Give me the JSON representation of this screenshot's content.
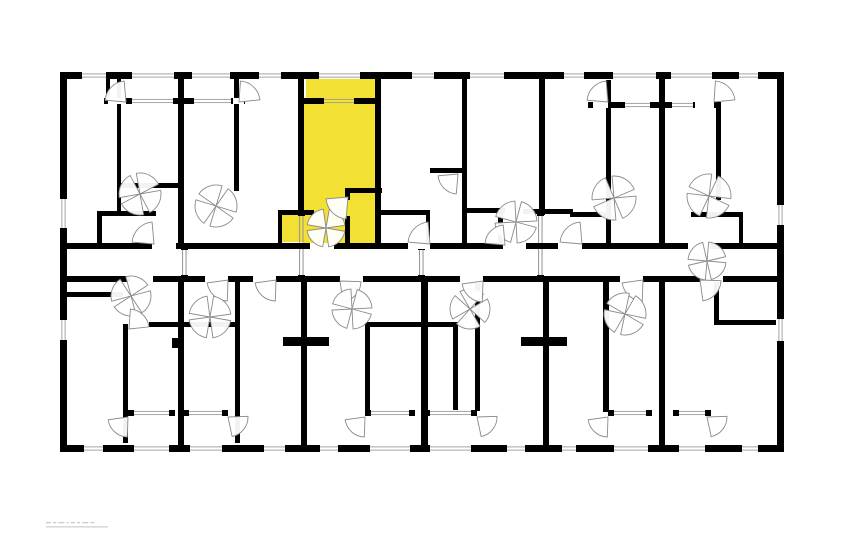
{
  "canvas": {
    "width": 862,
    "height": 555,
    "background": "#ffffff"
  },
  "colors": {
    "wall": "#000000",
    "highlight": "#F2E032",
    "arc_stroke": "#8a8a8a",
    "glazing_line": "#9b9b9b",
    "watermark_gray": "#b9b9b9"
  },
  "plan": {
    "highlighted_unit": {
      "fill": "#F2E032",
      "areas": [
        [
          306,
          79,
          69,
          19
        ],
        [
          304,
          104,
          71,
          139
        ],
        [
          281,
          215,
          23,
          27
        ]
      ]
    },
    "walls": [
      [
        60,
        72,
        724,
        7
      ],
      [
        60,
        445,
        724,
        7
      ],
      [
        60,
        72,
        7,
        380
      ],
      [
        777,
        72,
        7,
        380
      ],
      [
        60,
        243,
        724,
        6
      ],
      [
        60,
        276,
        724,
        6
      ],
      [
        106,
        79,
        4,
        19
      ],
      [
        117,
        79,
        4,
        132
      ],
      [
        178,
        72,
        6,
        177
      ],
      [
        234,
        79,
        5,
        112
      ],
      [
        298,
        72,
        6,
        143
      ],
      [
        375,
        72,
        6,
        177
      ],
      [
        462,
        72,
        5,
        171
      ],
      [
        539,
        72,
        6,
        143
      ],
      [
        606,
        80,
        5,
        167
      ],
      [
        659,
        72,
        6,
        177
      ],
      [
        716,
        102,
        5,
        98
      ],
      [
        104,
        98,
        141,
        6
      ],
      [
        298,
        98,
        83,
        6
      ],
      [
        588,
        102,
        133,
        6
      ],
      [
        120,
        183,
        62,
        5
      ],
      [
        97,
        211,
        59,
        5
      ],
      [
        97,
        211,
        5,
        34
      ],
      [
        345,
        188,
        37,
        5
      ],
      [
        345,
        188,
        5,
        12
      ],
      [
        345,
        216,
        5,
        29
      ],
      [
        278,
        210,
        36,
        5
      ],
      [
        278,
        212,
        4,
        32
      ],
      [
        381,
        210,
        49,
        5
      ],
      [
        426,
        210,
        4,
        35
      ],
      [
        430,
        168,
        34,
        5
      ],
      [
        462,
        208,
        43,
        5
      ],
      [
        498,
        213,
        5,
        34
      ],
      [
        523,
        209,
        50,
        5
      ],
      [
        570,
        212,
        37,
        5
      ],
      [
        691,
        212,
        52,
        5
      ],
      [
        739,
        217,
        4,
        28
      ],
      [
        123,
        324,
        5,
        119
      ],
      [
        178,
        276,
        6,
        171
      ],
      [
        235,
        282,
        5,
        161
      ],
      [
        301,
        276,
        6,
        171
      ],
      [
        421,
        276,
        7,
        171
      ],
      [
        475,
        283,
        5,
        128
      ],
      [
        543,
        276,
        6,
        171
      ],
      [
        603,
        282,
        6,
        130
      ],
      [
        659,
        276,
        6,
        171
      ],
      [
        714,
        282,
        5,
        43
      ],
      [
        60,
        292,
        63,
        5
      ],
      [
        149,
        322,
        90,
        5
      ],
      [
        365,
        322,
        59,
        5
      ],
      [
        424,
        322,
        34,
        5
      ],
      [
        365,
        323,
        5,
        89
      ],
      [
        453,
        323,
        5,
        89
      ],
      [
        283,
        337,
        46,
        9
      ],
      [
        521,
        337,
        46,
        9
      ],
      [
        172,
        338,
        8,
        10
      ],
      [
        714,
        320,
        62,
        5
      ],
      [
        128,
        410,
        47,
        6
      ],
      [
        183,
        410,
        45,
        6
      ],
      [
        365,
        410,
        50,
        6
      ],
      [
        424,
        410,
        53,
        6
      ],
      [
        608,
        410,
        44,
        6
      ],
      [
        673,
        410,
        38,
        6
      ]
    ],
    "openings": [
      {
        "x": 80,
        "y": 72,
        "w": 28,
        "h": 7,
        "t": "window"
      },
      {
        "x": 130,
        "y": 72,
        "w": 46,
        "h": 7,
        "t": "glazing"
      },
      {
        "x": 190,
        "y": 72,
        "w": 42,
        "h": 7,
        "t": "glazing"
      },
      {
        "x": 257,
        "y": 72,
        "w": 26,
        "h": 7,
        "t": "window"
      },
      {
        "x": 317,
        "y": 72,
        "w": 45,
        "h": 7,
        "t": "glazing"
      },
      {
        "x": 410,
        "y": 72,
        "w": 26,
        "h": 7,
        "t": "window"
      },
      {
        "x": 468,
        "y": 72,
        "w": 38,
        "h": 7,
        "t": "window"
      },
      {
        "x": 562,
        "y": 72,
        "w": 24,
        "h": 7,
        "t": "window"
      },
      {
        "x": 611,
        "y": 72,
        "w": 47,
        "h": 7,
        "t": "glazing"
      },
      {
        "x": 669,
        "y": 72,
        "w": 45,
        "h": 7,
        "t": "glazing"
      },
      {
        "x": 737,
        "y": 72,
        "w": 23,
        "h": 7,
        "t": "window"
      },
      {
        "x": 82,
        "y": 445,
        "w": 23,
        "h": 7,
        "t": "window"
      },
      {
        "x": 132,
        "y": 445,
        "w": 39,
        "h": 7,
        "t": "glazing"
      },
      {
        "x": 188,
        "y": 445,
        "w": 36,
        "h": 7,
        "t": "glazing"
      },
      {
        "x": 262,
        "y": 445,
        "w": 25,
        "h": 7,
        "t": "window"
      },
      {
        "x": 318,
        "y": 445,
        "w": 22,
        "h": 7,
        "t": "window"
      },
      {
        "x": 368,
        "y": 445,
        "w": 44,
        "h": 7,
        "t": "glazing"
      },
      {
        "x": 428,
        "y": 445,
        "w": 45,
        "h": 7,
        "t": "glazing"
      },
      {
        "x": 505,
        "y": 445,
        "w": 22,
        "h": 7,
        "t": "window"
      },
      {
        "x": 560,
        "y": 445,
        "w": 18,
        "h": 7,
        "t": "window"
      },
      {
        "x": 612,
        "y": 445,
        "w": 38,
        "h": 7,
        "t": "glazing"
      },
      {
        "x": 677,
        "y": 445,
        "w": 30,
        "h": 7,
        "t": "glazing"
      },
      {
        "x": 740,
        "y": 445,
        "w": 20,
        "h": 7,
        "t": "window"
      },
      {
        "x": 60,
        "y": 197,
        "w": 7,
        "h": 33,
        "t": "window"
      },
      {
        "x": 60,
        "y": 318,
        "w": 7,
        "h": 24,
        "t": "window"
      },
      {
        "x": 777,
        "y": 203,
        "w": 7,
        "h": 24,
        "t": "window"
      },
      {
        "x": 777,
        "y": 317,
        "w": 7,
        "h": 26,
        "t": "window"
      },
      {
        "x": 130,
        "y": 98,
        "w": 45,
        "h": 6,
        "t": "glazing"
      },
      {
        "x": 192,
        "y": 98,
        "w": 41,
        "h": 6,
        "t": "glazing"
      },
      {
        "x": 322,
        "y": 98,
        "w": 34,
        "h": 6,
        "t": "glazing",
        "bg": "#F2E032"
      },
      {
        "x": 623,
        "y": 102,
        "w": 29,
        "h": 6,
        "t": "glazing"
      },
      {
        "x": 670,
        "y": 102,
        "w": 25,
        "h": 6,
        "t": "glazing"
      },
      {
        "x": 108,
        "y": 98,
        "w": 18,
        "h": 6,
        "t": "gap"
      },
      {
        "x": 233,
        "y": 98,
        "w": 11,
        "h": 6,
        "t": "gap"
      },
      {
        "x": 593,
        "y": 102,
        "w": 15,
        "h": 6,
        "t": "gap"
      },
      {
        "x": 695,
        "y": 102,
        "w": 19,
        "h": 6,
        "t": "gap"
      },
      {
        "x": 152,
        "y": 243,
        "w": 24,
        "h": 6,
        "t": "gap"
      },
      {
        "x": 310,
        "y": 243,
        "w": 24,
        "h": 6,
        "t": "gap"
      },
      {
        "x": 408,
        "y": 243,
        "w": 22,
        "h": 6,
        "t": "gap"
      },
      {
        "x": 503,
        "y": 243,
        "w": 23,
        "h": 6,
        "t": "gap"
      },
      {
        "x": 558,
        "y": 243,
        "w": 24,
        "h": 6,
        "t": "gap"
      },
      {
        "x": 688,
        "y": 243,
        "w": 22,
        "h": 6,
        "t": "gap"
      },
      {
        "x": 130,
        "y": 276,
        "w": 23,
        "h": 6,
        "t": "gap"
      },
      {
        "x": 205,
        "y": 276,
        "w": 23,
        "h": 6,
        "t": "gap"
      },
      {
        "x": 253,
        "y": 276,
        "w": 23,
        "h": 6,
        "t": "gap"
      },
      {
        "x": 340,
        "y": 276,
        "w": 23,
        "h": 6,
        "t": "gap"
      },
      {
        "x": 460,
        "y": 276,
        "w": 23,
        "h": 6,
        "t": "gap"
      },
      {
        "x": 620,
        "y": 276,
        "w": 23,
        "h": 6,
        "t": "gap"
      },
      {
        "x": 700,
        "y": 276,
        "w": 23,
        "h": 6,
        "t": "gap"
      },
      {
        "x": 132,
        "y": 410,
        "w": 39,
        "h": 6,
        "t": "glazing"
      },
      {
        "x": 187,
        "y": 410,
        "w": 37,
        "h": 6,
        "t": "glazing"
      },
      {
        "x": 369,
        "y": 410,
        "w": 42,
        "h": 6,
        "t": "glazing"
      },
      {
        "x": 428,
        "y": 410,
        "w": 45,
        "h": 6,
        "t": "glazing"
      },
      {
        "x": 612,
        "y": 410,
        "w": 36,
        "h": 6,
        "t": "glazing"
      },
      {
        "x": 677,
        "y": 410,
        "w": 30,
        "h": 6,
        "t": "glazing"
      }
    ],
    "partitions": [
      {
        "x": 182,
        "y": 249,
        "h": 27
      },
      {
        "x": 299,
        "y": 215,
        "h": 61
      },
      {
        "x": 419,
        "y": 249,
        "h": 27
      },
      {
        "x": 538,
        "y": 215,
        "h": 61
      }
    ],
    "doors": [
      {
        "c": [
          126,
          102
        ],
        "r": 21,
        "a": 185,
        "p": 1
      },
      {
        "c": [
          239,
          102
        ],
        "r": 21,
        "a": 274,
        "p": 1
      },
      {
        "c": [
          608,
          102
        ],
        "r": 21,
        "a": 185,
        "p": 1
      },
      {
        "c": [
          714,
          102
        ],
        "r": 21,
        "a": 274,
        "p": 1
      },
      {
        "c": [
          140,
          194
        ],
        "r": 21,
        "a": -10,
        "p": 4
      },
      {
        "c": [
          216,
          206
        ],
        "r": 21,
        "a": 35,
        "p": 4
      },
      {
        "c": [
          326,
          228
        ],
        "r": 19,
        "a": 10,
        "p": 4
      },
      {
        "c": [
          348,
          197
        ],
        "r": 22,
        "a": 95,
        "p": 1
      },
      {
        "c": [
          430,
          244
        ],
        "r": 22,
        "a": 185,
        "p": 1
      },
      {
        "c": [
          458,
          174
        ],
        "r": 20,
        "a": 95,
        "p": 1
      },
      {
        "c": [
          516,
          222
        ],
        "r": 21,
        "a": 15,
        "p": 4
      },
      {
        "c": [
          614,
          198
        ],
        "r": 22,
        "a": -5,
        "p": 4
      },
      {
        "c": [
          709,
          196
        ],
        "r": 22,
        "a": 25,
        "p": 4
      },
      {
        "c": [
          154,
          244
        ],
        "r": 22,
        "a": 185,
        "p": 1
      },
      {
        "c": [
          505,
          245
        ],
        "r": 20,
        "a": 185,
        "p": 1
      },
      {
        "c": [
          582,
          244
        ],
        "r": 22,
        "a": 185,
        "p": 1
      },
      {
        "c": [
          707,
          261
        ],
        "r": 19,
        "a": 5,
        "p": 4
      },
      {
        "c": [
          131,
          296
        ],
        "r": 20,
        "a": -15,
        "p": 4
      },
      {
        "c": [
          129,
          329
        ],
        "r": 20,
        "a": 274,
        "p": 1
      },
      {
        "c": [
          228,
          280
        ],
        "r": 21,
        "a": 92,
        "p": 1
      },
      {
        "c": [
          210,
          317
        ],
        "r": 21,
        "a": 10,
        "p": 4
      },
      {
        "c": [
          276,
          280
        ],
        "r": 21,
        "a": 92,
        "p": 1
      },
      {
        "c": [
          340,
          281
        ],
        "r": 21,
        "a": 2,
        "p": 1
      },
      {
        "c": [
          352,
          309
        ],
        "r": 20,
        "a": 15,
        "p": 4
      },
      {
        "c": [
          470,
          309
        ],
        "r": 20,
        "a": 150,
        "p": 4
      },
      {
        "c": [
          483,
          281
        ],
        "r": 21,
        "a": 92,
        "p": 1
      },
      {
        "c": [
          643,
          280
        ],
        "r": 21,
        "a": 92,
        "p": 1
      },
      {
        "c": [
          700,
          280
        ],
        "r": 21,
        "a": 2,
        "p": 1
      },
      {
        "c": [
          625,
          314
        ],
        "r": 21,
        "a": 30,
        "p": 4
      },
      {
        "c": [
          128,
          417
        ],
        "r": 20,
        "a": 92,
        "p": 1
      },
      {
        "c": [
          228,
          417
        ],
        "r": 20,
        "a": -2,
        "p": 1
      },
      {
        "c": [
          365,
          417
        ],
        "r": 20,
        "a": 92,
        "p": 1
      },
      {
        "c": [
          477,
          417
        ],
        "r": 20,
        "a": -2,
        "p": 1
      },
      {
        "c": [
          608,
          417
        ],
        "r": 20,
        "a": 92,
        "p": 1
      },
      {
        "c": [
          707,
          417
        ],
        "r": 20,
        "a": -2,
        "p": 1
      }
    ]
  },
  "watermark": {
    "x": 46,
    "y": 521,
    "width": 62,
    "height": 9
  }
}
